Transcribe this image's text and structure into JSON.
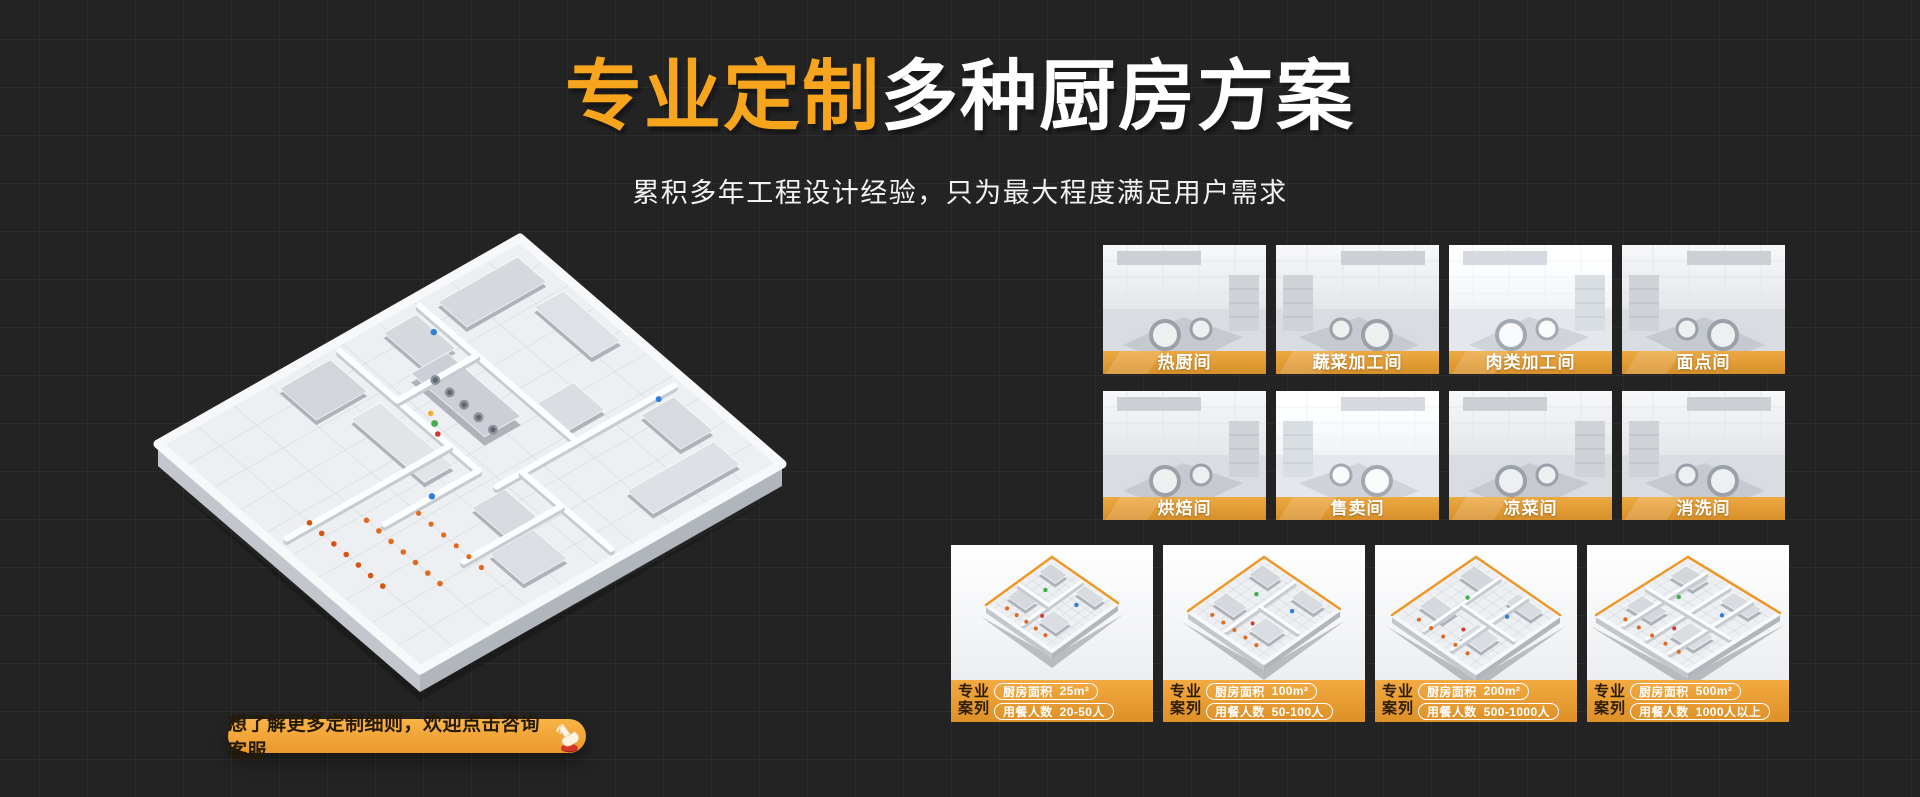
{
  "hero": {
    "title_highlight": "专业定制",
    "title_rest": "多种厨房方案",
    "subtitle": "累积多年工程设计经验，只为最大程度满足用户需求"
  },
  "cta": {
    "label": "想了解更多定制细则，欢迎点击咨询客服",
    "icon": "tap-hand-icon"
  },
  "rooms": {
    "items": [
      {
        "label": "热厨间"
      },
      {
        "label": "蔬菜加工间"
      },
      {
        "label": "肉类加工间"
      },
      {
        "label": "面点间"
      },
      {
        "label": "烘焙间"
      },
      {
        "label": "售卖间"
      },
      {
        "label": "凉菜间"
      },
      {
        "label": "消洗间"
      }
    ]
  },
  "cases": {
    "badge_top": "专业",
    "badge_bottom": "案列",
    "area_label": "厨房面积",
    "diners_label": "用餐人数",
    "items": [
      {
        "area": "25m²",
        "diners": "20-50人"
      },
      {
        "area": "100m²",
        "diners": "50-100人"
      },
      {
        "area": "200m²",
        "diners": "500-1000人"
      },
      {
        "area": "500m²",
        "diners": "1000人以上"
      }
    ]
  },
  "colors": {
    "accent": "#F7A51D",
    "band": "#E49B33",
    "background": "#232323"
  }
}
